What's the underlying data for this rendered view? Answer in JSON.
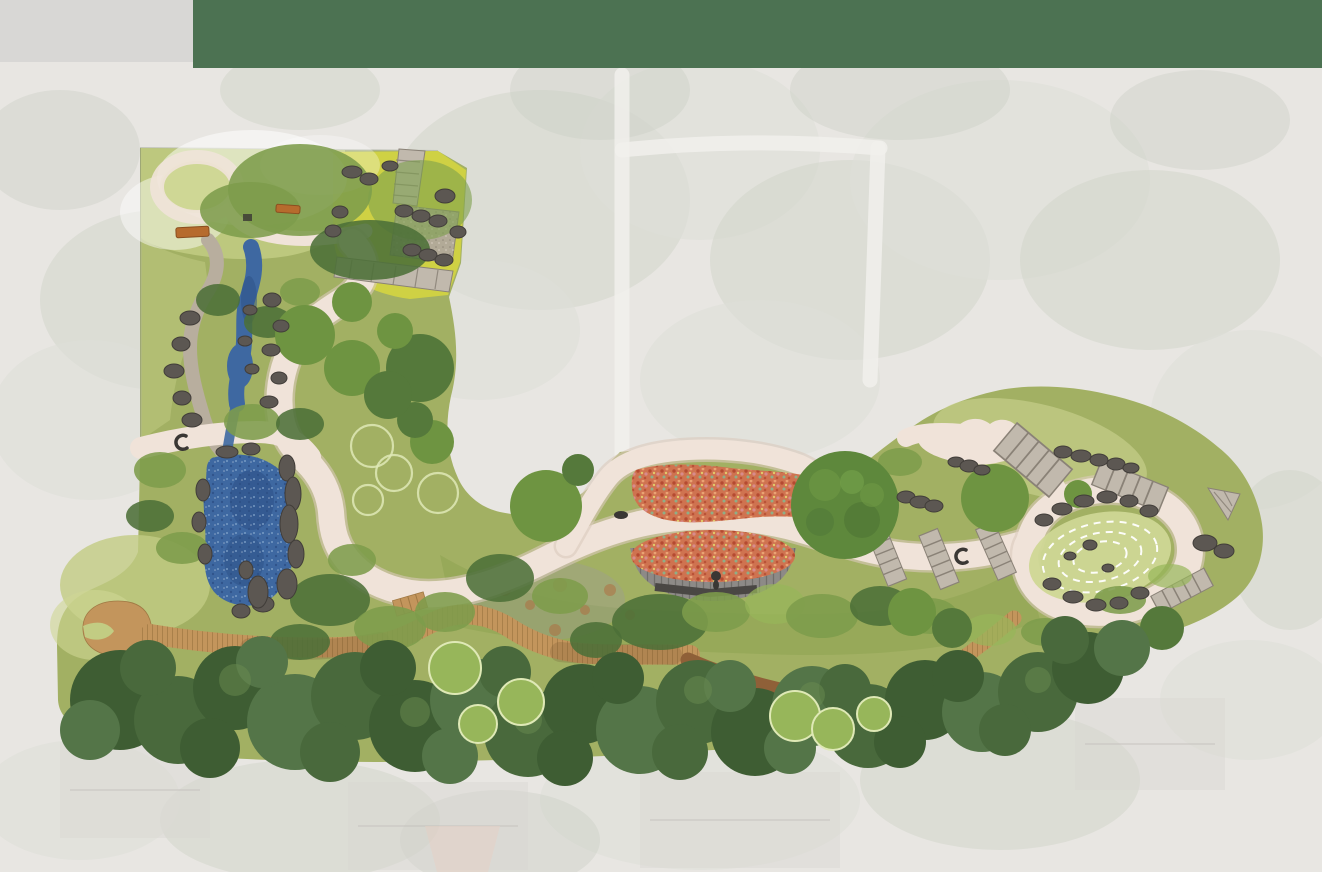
{
  "scene": {
    "kind": "landscape-master-plan-rendering",
    "header_band": "",
    "notes": ""
  },
  "palette": {
    "bg": "#E8E6E2",
    "band": "#4C7252",
    "panel": "#D8D7D5",
    "blotch1": "#D2D5CB",
    "blotch2": "#DDDFD8",
    "blotch3": "#C9CDC2",
    "road": "#F1F0EC",
    "house": "#D9D7D2",
    "roofPink": "#E7CFC3",
    "roofLine": "#C4C2BD",
    "siteBase": "#A2B063",
    "lawnLight": "#C2CC83",
    "lawnPale": "#CFD795",
    "meadowYellow": "#D2D441",
    "washWhite": "#FFFFFF",
    "shrubDark": "#4C7038",
    "shrubMid": "#7D9C4B",
    "oliveUnder": "#8FA553",
    "canopy1": "#3E5D33",
    "canopy2": "#49693C",
    "canopy3": "#547548",
    "canopyHl": "#6A8C50",
    "treeMid": "#6E9441",
    "treeDeep": "#55793B",
    "treeLight": "#97B65A",
    "ringStroke": "#DFE9B6",
    "path": "#F0E3D9",
    "pathEdge": "#DBC9BD",
    "gravel": "#B8AE9E",
    "flagstone": "#C1B9AD",
    "flagLine": "#8A8277",
    "terrace": "#B1A89C",
    "water": "#3E68A1",
    "waterDark": "#2C4F86",
    "waterLight": "#85A8CE",
    "rock": "#5C5752",
    "rockEdge": "#413D39",
    "wood": "#C3955C",
    "woodLine": "#A07944",
    "woodShadow": "#6E4D2D",
    "mulch": "#8F6038",
    "deck": "#8D8A87",
    "deckLine": "#6B6865",
    "benchDark": "#4A4744",
    "red": "#CF7350",
    "redDark": "#B54A31",
    "redLight": "#EAA273",
    "redPink": "#D88B8C",
    "redGreen": "#8FAE87",
    "benchOrange": "#B66B2D",
    "figure": "#3A3734",
    "lavender": "#9B94A1",
    "rust": "#B06A3C"
  },
  "features": {
    "aerial_blotches": {
      "shape": "ellipse",
      "item_name": "aerial-texture-blob",
      "items": [
        [
          160,
          300,
          120,
          90,
          "b1"
        ],
        [
          90,
          420,
          100,
          80,
          "b2"
        ],
        [
          300,
          90,
          80,
          40,
          "b1"
        ],
        [
          540,
          200,
          150,
          110,
          "b1"
        ],
        [
          700,
          150,
          120,
          90,
          "b2"
        ],
        [
          850,
          260,
          140,
          100,
          "b1"
        ],
        [
          760,
          380,
          120,
          80,
          "b2"
        ],
        [
          1000,
          180,
          150,
          100,
          "b2"
        ],
        [
          1150,
          260,
          130,
          90,
          "b1"
        ],
        [
          1250,
          420,
          100,
          90,
          "b2"
        ],
        [
          1100,
          520,
          90,
          60,
          "b1"
        ],
        [
          480,
          330,
          100,
          70,
          "b2"
        ],
        [
          600,
          90,
          90,
          50,
          "b3"
        ],
        [
          900,
          90,
          110,
          50,
          "b3"
        ],
        [
          1200,
          120,
          90,
          50,
          "b3"
        ],
        [
          300,
          820,
          140,
          60,
          "b1"
        ],
        [
          700,
          800,
          160,
          70,
          "b2"
        ],
        [
          1000,
          780,
          140,
          70,
          "b1"
        ],
        [
          1250,
          700,
          90,
          60,
          "b2"
        ],
        [
          80,
          800,
          100,
          60,
          "b2"
        ],
        [
          500,
          840,
          100,
          50,
          "b3"
        ],
        [
          60,
          150,
          80,
          60,
          "b3"
        ],
        [
          1290,
          550,
          60,
          80,
          "b1"
        ]
      ]
    },
    "south_canopy": {
      "shape": "circle",
      "item_name": "canopy-tree",
      "items": [
        [
          120,
          700,
          50,
          "c1"
        ],
        [
          178,
          720,
          44,
          "c2"
        ],
        [
          235,
          688,
          42,
          "c1"
        ],
        [
          295,
          722,
          48,
          "c3"
        ],
        [
          355,
          696,
          44,
          "c2"
        ],
        [
          415,
          726,
          46,
          "c1"
        ],
        [
          472,
          700,
          42,
          "c3"
        ],
        [
          528,
          733,
          44,
          "c2"
        ],
        [
          582,
          704,
          40,
          "c1"
        ],
        [
          640,
          730,
          44,
          "c3"
        ],
        [
          698,
          702,
          42,
          "c2"
        ],
        [
          755,
          732,
          44,
          "c1"
        ],
        [
          812,
          706,
          40,
          "c3"
        ],
        [
          868,
          726,
          42,
          "c2"
        ],
        [
          925,
          700,
          40,
          "c1"
        ],
        [
          982,
          712,
          40,
          "c3"
        ],
        [
          1038,
          692,
          40,
          "c2"
        ],
        [
          1088,
          668,
          36,
          "c1"
        ],
        [
          1122,
          648,
          28,
          "c3"
        ],
        [
          148,
          668,
          28,
          "c2"
        ],
        [
          262,
          662,
          26,
          "c3"
        ],
        [
          388,
          668,
          28,
          "c1"
        ],
        [
          505,
          672,
          26,
          "c2"
        ],
        [
          618,
          678,
          26,
          "c1"
        ],
        [
          730,
          686,
          26,
          "c3"
        ],
        [
          845,
          690,
          26,
          "c2"
        ],
        [
          958,
          676,
          26,
          "c1"
        ],
        [
          1065,
          640,
          24,
          "c2"
        ],
        [
          90,
          730,
          30,
          "c3"
        ],
        [
          210,
          748,
          30,
          "c1"
        ],
        [
          330,
          752,
          30,
          "c2"
        ],
        [
          450,
          756,
          28,
          "c3"
        ],
        [
          565,
          758,
          28,
          "c1"
        ],
        [
          680,
          752,
          28,
          "c2"
        ],
        [
          790,
          748,
          26,
          "c3"
        ],
        [
          900,
          742,
          26,
          "c1"
        ],
        [
          1005,
          730,
          26,
          "c2"
        ],
        [
          235,
          680,
          16,
          "hl"
        ],
        [
          415,
          712,
          15,
          "hl"
        ],
        [
          528,
          720,
          14,
          "hl"
        ],
        [
          698,
          690,
          14,
          "hl"
        ],
        [
          812,
          695,
          13,
          "hl"
        ],
        [
          1038,
          680,
          13,
          "hl"
        ]
      ]
    },
    "mid_shrubs": {
      "shape": "ellipse",
      "item_name": "shrub-mass",
      "items": [
        [
          330,
          600,
          40,
          26,
          "sd"
        ],
        [
          390,
          628,
          36,
          22,
          "sm"
        ],
        [
          300,
          642,
          30,
          18,
          "sd"
        ],
        [
          445,
          612,
          30,
          20,
          "sm"
        ],
        [
          500,
          578,
          34,
          24,
          "sd"
        ],
        [
          560,
          596,
          28,
          18,
          "sm"
        ],
        [
          596,
          640,
          26,
          18,
          "sd"
        ],
        [
          660,
          622,
          48,
          28,
          "sd"
        ],
        [
          716,
          612,
          34,
          20,
          "sm"
        ],
        [
          775,
          604,
          30,
          20,
          "sp"
        ],
        [
          822,
          616,
          36,
          22,
          "sm"
        ],
        [
          880,
          606,
          30,
          20,
          "sd"
        ],
        [
          930,
          616,
          28,
          18,
          "sm"
        ],
        [
          990,
          630,
          26,
          16,
          "sp"
        ],
        [
          1045,
          632,
          24,
          14,
          "sm"
        ],
        [
          160,
          470,
          26,
          18,
          "sm"
        ],
        [
          150,
          516,
          24,
          16,
          "sd"
        ],
        [
          182,
          548,
          26,
          16,
          "sm"
        ],
        [
          218,
          300,
          22,
          16,
          "sd"
        ],
        [
          268,
          322,
          24,
          16,
          "sd"
        ],
        [
          300,
          292,
          20,
          14,
          "sm"
        ],
        [
          252,
          422,
          28,
          18,
          "sm"
        ],
        [
          300,
          424,
          24,
          16,
          "sd"
        ],
        [
          352,
          560,
          24,
          16,
          "sm"
        ],
        [
          860,
          480,
          26,
          18,
          "sd"
        ],
        [
          900,
          462,
          22,
          14,
          "sm"
        ],
        [
          1120,
          600,
          26,
          14,
          "sm"
        ],
        [
          1170,
          576,
          22,
          12,
          "sp"
        ]
      ]
    },
    "accent_trees": {
      "shape": "circle",
      "item_name": "tree",
      "items": [
        [
          546,
          506,
          36,
          "tm"
        ],
        [
          995,
          498,
          34,
          "tm"
        ],
        [
          1078,
          494,
          14,
          "tm"
        ],
        [
          432,
          442,
          22,
          "tm"
        ],
        [
          415,
          420,
          18,
          "td"
        ],
        [
          420,
          368,
          34,
          "td"
        ],
        [
          912,
          612,
          24,
          "tm"
        ],
        [
          952,
          628,
          20,
          "td"
        ],
        [
          1162,
          628,
          22,
          "td"
        ],
        [
          305,
          335,
          30,
          "tm"
        ],
        [
          352,
          368,
          28,
          "tm"
        ],
        [
          388,
          395,
          24,
          "td"
        ],
        [
          352,
          302,
          20,
          "tm"
        ],
        [
          395,
          331,
          18,
          "tm"
        ],
        [
          578,
          470,
          16,
          "td"
        ]
      ]
    },
    "ring_fill_trees": {
      "shape": "circle",
      "class": "ringFill",
      "item_name": "ornamental-tree",
      "items": [
        [
          455,
          668,
          26
        ],
        [
          521,
          702,
          23
        ],
        [
          478,
          724,
          19
        ],
        [
          795,
          716,
          25
        ],
        [
          833,
          729,
          21
        ],
        [
          874,
          714,
          17
        ]
      ]
    },
    "ring_outline_trees": {
      "shape": "circle",
      "class": "ringOnly",
      "item_name": "proposed-tree-outline",
      "items": [
        [
          372,
          446,
          21
        ],
        [
          394,
          473,
          18
        ],
        [
          438,
          493,
          20
        ],
        [
          368,
          500,
          15
        ]
      ]
    },
    "rust_patches": {
      "shape": "circle",
      "class": "rustDot",
      "item_name": "rust-planting-dot",
      "items": [
        [
          505,
          590,
          6
        ],
        [
          530,
          605,
          5
        ],
        [
          560,
          585,
          7
        ],
        [
          585,
          610,
          5
        ],
        [
          610,
          590,
          6
        ],
        [
          480,
          610,
          5
        ],
        [
          555,
          630,
          6
        ],
        [
          630,
          615,
          5
        ]
      ]
    },
    "rocks": {
      "shape": "ellipse",
      "class": "rock",
      "item_name": "boulder",
      "items": [
        [
          287,
          468,
          8,
          13
        ],
        [
          293,
          494,
          8,
          17
        ],
        [
          289,
          524,
          9,
          19
        ],
        [
          296,
          554,
          8,
          14
        ],
        [
          287,
          584,
          10,
          15
        ],
        [
          263,
          604,
          11,
          8
        ],
        [
          241,
          611,
          9,
          7
        ],
        [
          203,
          490,
          7,
          11
        ],
        [
          199,
          522,
          7,
          10
        ],
        [
          205,
          554,
          7,
          10
        ],
        [
          227,
          452,
          11,
          6
        ],
        [
          251,
          449,
          9,
          6
        ],
        [
          190,
          318,
          10,
          7
        ],
        [
          181,
          344,
          9,
          7
        ],
        [
          174,
          371,
          10,
          7
        ],
        [
          182,
          398,
          9,
          7
        ],
        [
          192,
          420,
          10,
          7
        ],
        [
          272,
          300,
          9,
          7
        ],
        [
          281,
          326,
          8,
          6
        ],
        [
          271,
          350,
          9,
          6
        ],
        [
          279,
          378,
          8,
          6
        ],
        [
          269,
          402,
          9,
          6
        ],
        [
          250,
          310,
          7,
          5
        ],
        [
          245,
          341,
          7,
          5
        ],
        [
          252,
          369,
          7,
          5
        ],
        [
          352,
          172,
          10,
          6
        ],
        [
          369,
          179,
          9,
          6
        ],
        [
          340,
          212,
          8,
          6
        ],
        [
          333,
          231,
          8,
          6
        ],
        [
          404,
          211,
          9,
          6
        ],
        [
          421,
          216,
          9,
          6
        ],
        [
          438,
          221,
          9,
          6
        ],
        [
          412,
          250,
          9,
          6
        ],
        [
          428,
          255,
          9,
          6
        ],
        [
          444,
          260,
          9,
          6
        ],
        [
          390,
          166,
          8,
          5
        ],
        [
          445,
          196,
          10,
          7
        ],
        [
          458,
          232,
          8,
          6
        ],
        [
          906,
          497,
          9,
          6
        ],
        [
          920,
          502,
          10,
          6
        ],
        [
          934,
          506,
          9,
          6
        ],
        [
          956,
          462,
          8,
          5
        ],
        [
          969,
          466,
          9,
          6
        ],
        [
          982,
          470,
          8,
          5
        ],
        [
          1063,
          452,
          9,
          6
        ],
        [
          1081,
          456,
          10,
          6
        ],
        [
          1099,
          460,
          9,
          6
        ],
        [
          1116,
          464,
          9,
          6
        ],
        [
          1131,
          468,
          8,
          5
        ],
        [
          1205,
          543,
          12,
          8
        ],
        [
          1224,
          551,
          10,
          7
        ],
        [
          1044,
          520,
          9,
          6
        ],
        [
          1062,
          509,
          10,
          6
        ],
        [
          1084,
          501,
          10,
          6
        ],
        [
          1107,
          497,
          10,
          6
        ],
        [
          1129,
          501,
          9,
          6
        ],
        [
          1149,
          511,
          9,
          6
        ],
        [
          1052,
          584,
          9,
          6
        ],
        [
          1073,
          597,
          10,
          6
        ],
        [
          1096,
          605,
          10,
          6
        ],
        [
          1119,
          603,
          9,
          6
        ],
        [
          1140,
          593,
          9,
          6
        ],
        [
          1090,
          545,
          7,
          5
        ],
        [
          1070,
          556,
          6,
          4
        ],
        [
          1108,
          568,
          6,
          4
        ],
        [
          258,
          592,
          10,
          16
        ],
        [
          246,
          570,
          7,
          9
        ]
      ]
    }
  }
}
